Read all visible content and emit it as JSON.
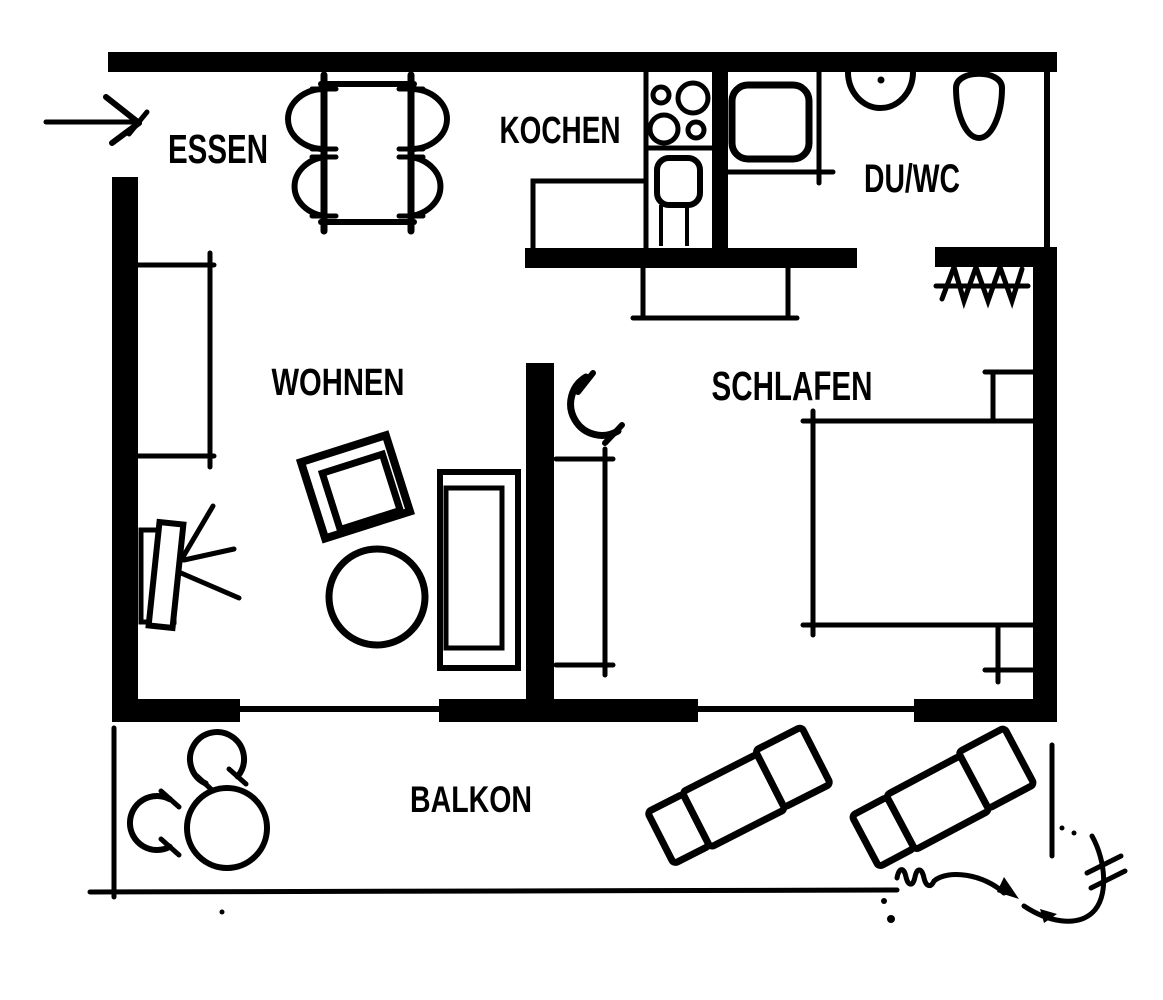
{
  "plan": {
    "rooms": {
      "essen": "ESSEN",
      "kochen": "KOCHEN",
      "duwc": "DU/WC",
      "wohnen": "WOHNEN",
      "schlafen": "SCHLAFEN",
      "balkon": "BALKON"
    }
  },
  "colors": {
    "ink": "#000000",
    "paper": "#ffffff"
  },
  "icons": {
    "entrance-arrow-icon": "arrow pointing right through entrance opening",
    "dining-table-icon": "rectangular table with four semicircular chairs",
    "stove-icon": "cooktop with four burner circles",
    "kitchen-sink-icon": "rounded square basin with cabinet lines",
    "kitchen-counter-line": "L-shaped counter outline",
    "shower-icon": "rounded square shower tray with screen lines",
    "washbasin-icon": "semicircular basin with tap dot",
    "toilet-icon": "oval bowl on wall",
    "coat-rack-icon": "rail with hanger zigzag marks",
    "door-swing-icon": "door swing arc with end ticks",
    "shelf-icon": "open rectangle against wall",
    "tv-icon": "tilted screen on board with three signal rays",
    "armchair-icon": "rotated square with inner square",
    "coffee-table-icon": "circle",
    "sofa-icon": "rectangle with inner seat rectangle",
    "sideboard-icon": "open-top rectangle under wall",
    "wardrobe-icon": "open rectangle beside partition",
    "bed-icon": "double bed rectangle with corner ticks",
    "nightstand-icon": "small open rectangle at wall",
    "balcony-table-icon": "circle with two arc chairs",
    "sun-lounger-icon": "tilted three-section lounger",
    "scribble-annotation": "handwritten squiggle with arrowheads, slashes and dots",
    "window-line": "thin line between thick wall segments"
  }
}
